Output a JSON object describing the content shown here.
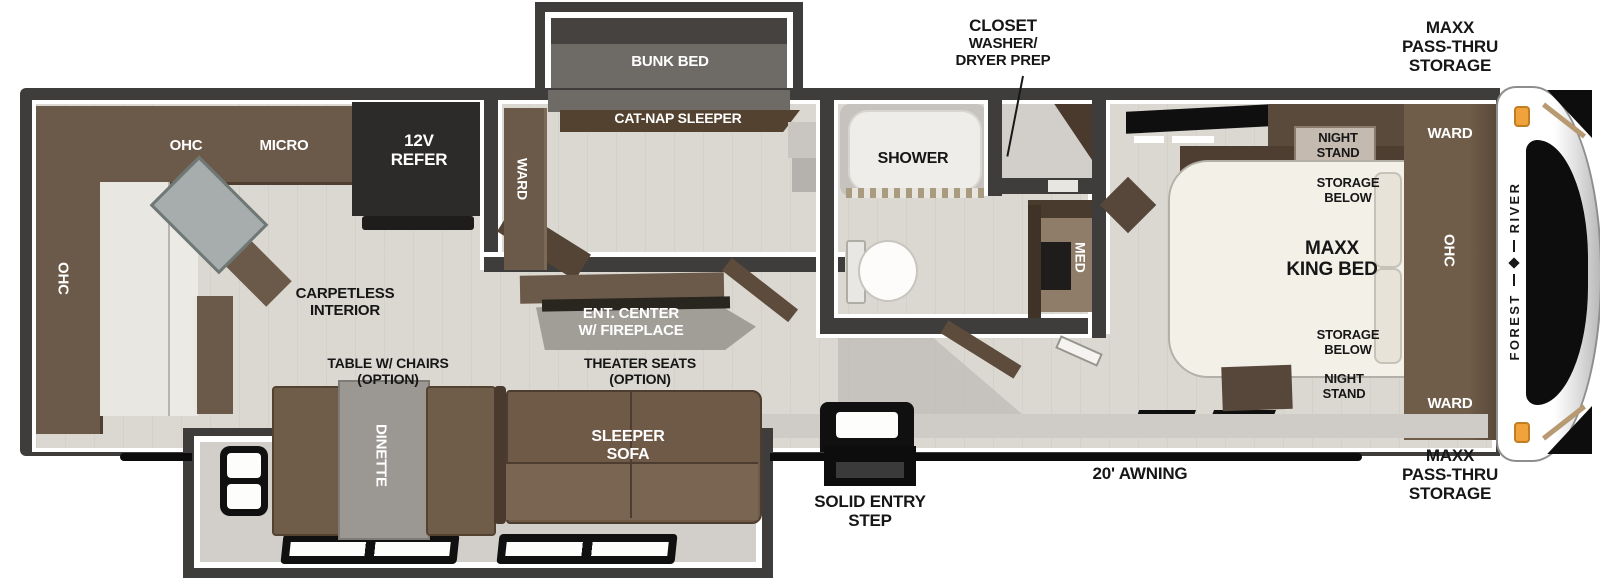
{
  "exterior": {
    "brand_first": "FOREST",
    "brand_second": "RIVER",
    "closet": {
      "l1": "CLOSET",
      "l2": "WASHER/",
      "l3": "DRYER PREP"
    },
    "passthru_top": {
      "l1": "MAXX",
      "l2": "PASS-THRU",
      "l3": "STORAGE"
    },
    "passthru_bottom": {
      "l1": "MAXX",
      "l2": "PASS-THRU",
      "l3": "STORAGE"
    },
    "awning": "20' AWNING",
    "entry_step": {
      "l1": "SOLID ENTRY",
      "l2": "STEP"
    }
  },
  "kitchen": {
    "ohc_top": "OHC",
    "micro": "MICRO",
    "refer": {
      "l1": "12V",
      "l2": "REFER"
    },
    "ohc_side": "OHC",
    "floor_note": {
      "l1": "CARPETLESS",
      "l2": "INTERIOR"
    }
  },
  "bunk": {
    "bunk": "BUNK BED",
    "catnap": "CAT-NAP SLEEPER",
    "ward": "WARD"
  },
  "living": {
    "ent": {
      "l1": "ENT. CENTER",
      "l2": "W/ FIREPLACE"
    },
    "table": {
      "l1": "TABLE W/ CHAIRS",
      "l2": "(OPTION)"
    },
    "theater": {
      "l1": "THEATER SEATS",
      "l2": "(OPTION)"
    },
    "dinette": "DINETTE",
    "sleeper": {
      "l1": "SLEEPER",
      "l2": "SOFA"
    }
  },
  "bath": {
    "shower": "SHOWER",
    "med": "MED"
  },
  "bed": {
    "ns_top": {
      "l1": "NIGHT",
      "l2": "STAND"
    },
    "storage_top": {
      "l1": "STORAGE",
      "l2": "BELOW"
    },
    "bed": {
      "l1": "MAXX",
      "l2": "KING BED"
    },
    "storage_bot": {
      "l1": "STORAGE",
      "l2": "BELOW"
    },
    "ns_bot": {
      "l1": "NIGHT",
      "l2": "STAND"
    },
    "ward_top": "WARD",
    "ohc": "OHC",
    "ward_bot": "WARD"
  },
  "colors": {
    "wall": "#3e3d3b",
    "cabinet": "#6b5a49",
    "floor": "#dbd8d2",
    "marker_light": "#f0a33c",
    "label_dark": "#161616",
    "label_light": "#ffffff"
  }
}
